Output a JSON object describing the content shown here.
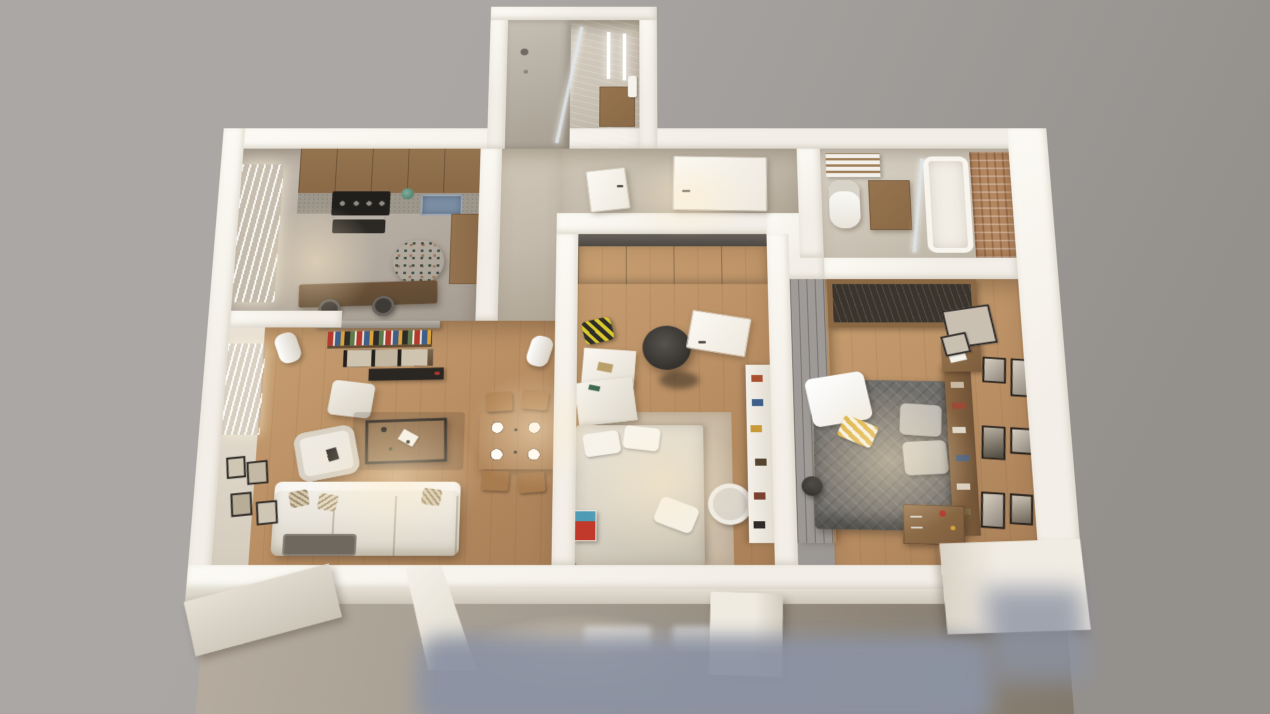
{
  "scene": {
    "type": "3d-floorplan-render",
    "view": "top-down-cutaway-perspective",
    "rooms": [
      {
        "name": "kitchen",
        "furniture": [
          "upper-cabinets",
          "gas-hob",
          "oven",
          "sink",
          "counter",
          "window-curtain",
          "mosaic-round-decor",
          "bar-counter",
          "bar-stools",
          "plant"
        ]
      },
      {
        "name": "living-room",
        "furniture": [
          "media-bracket",
          "media-shelf-books",
          "picture-row",
          "tv",
          "speakers",
          "pouf",
          "armchair",
          "coffee-table",
          "sectional-sofa",
          "throw-pillows",
          "wall-frames",
          "window-curtain",
          "rug"
        ]
      },
      {
        "name": "dining-area",
        "furniture": [
          "dining-table",
          "place-settings",
          "chairs"
        ]
      },
      {
        "name": "entry-hall",
        "furniture": [
          "front-door",
          "inner-door"
        ]
      },
      {
        "name": "shower-bathroom",
        "furniture": [
          "shower-head",
          "glass-partition",
          "mirror-lights",
          "vanity-cabinet",
          "towel"
        ]
      },
      {
        "name": "main-bathroom",
        "furniture": [
          "toilet",
          "towel-shelf",
          "vanity-cabinet",
          "bathtub",
          "glass-divider",
          "brick-accent-wall"
        ]
      },
      {
        "name": "bedroom-small",
        "furniture": [
          "sliding-wardrobe",
          "bed",
          "pillows",
          "floor-lamp",
          "white-desk",
          "backpack",
          "color-nightstand",
          "bookshelf",
          "laundry-basket",
          "door"
        ]
      },
      {
        "name": "bedroom-master",
        "furniture": [
          "slatted-wardrobe",
          "double-bed",
          "gray-quilt",
          "white-blanket",
          "yellow-striped-pillow",
          "gray-pillows",
          "headboard-shelf",
          "wood-plank-wall",
          "nightstand",
          "dresser",
          "floor-lamp",
          "gallery-frames",
          "large-frames"
        ]
      }
    ],
    "exterior": [
      "facade-wall",
      "facade-windows",
      "planter-stubs",
      "wall-wedge",
      "ground-shadow"
    ]
  },
  "palette": {
    "bg1": "#aba7a5",
    "bg2": "#94908c",
    "wall": "#f3efe8",
    "wall_lit": "#fcfaf4",
    "wall_shade": "#d4ccbd",
    "wall_face": "#e9e2d5",
    "floor_wood": "#b98e63",
    "floor_wood2": "#c79f71",
    "floor_conc": "#b3aa9f",
    "floor_entry": "#c3baac",
    "floor_tile": "#ccc4b6",
    "wood_cab": "#8a6947",
    "wood_dark": "#5f4a33",
    "counter": "#9d968a",
    "hob": "#211f1c",
    "sink": "#7a8da3",
    "teal": "#5e7a6e",
    "sofa": "#eae6de",
    "cushion": "#d9d2c3",
    "dark_tray": "#6f685e",
    "bed_gray": "#716f6c",
    "pillow_gray": "#b7b4ae",
    "blanket": "#efece6",
    "yellow": "#dcb23e",
    "bed_cream": "#dbd5c8",
    "rug": "#cfc5b4",
    "brick": "#b3875f",
    "frame": "#2b2724",
    "photo": "#c9c0b1",
    "facade": "#a49b90",
    "ground": "#8c93a3",
    "glow": "#ffe9c4"
  }
}
